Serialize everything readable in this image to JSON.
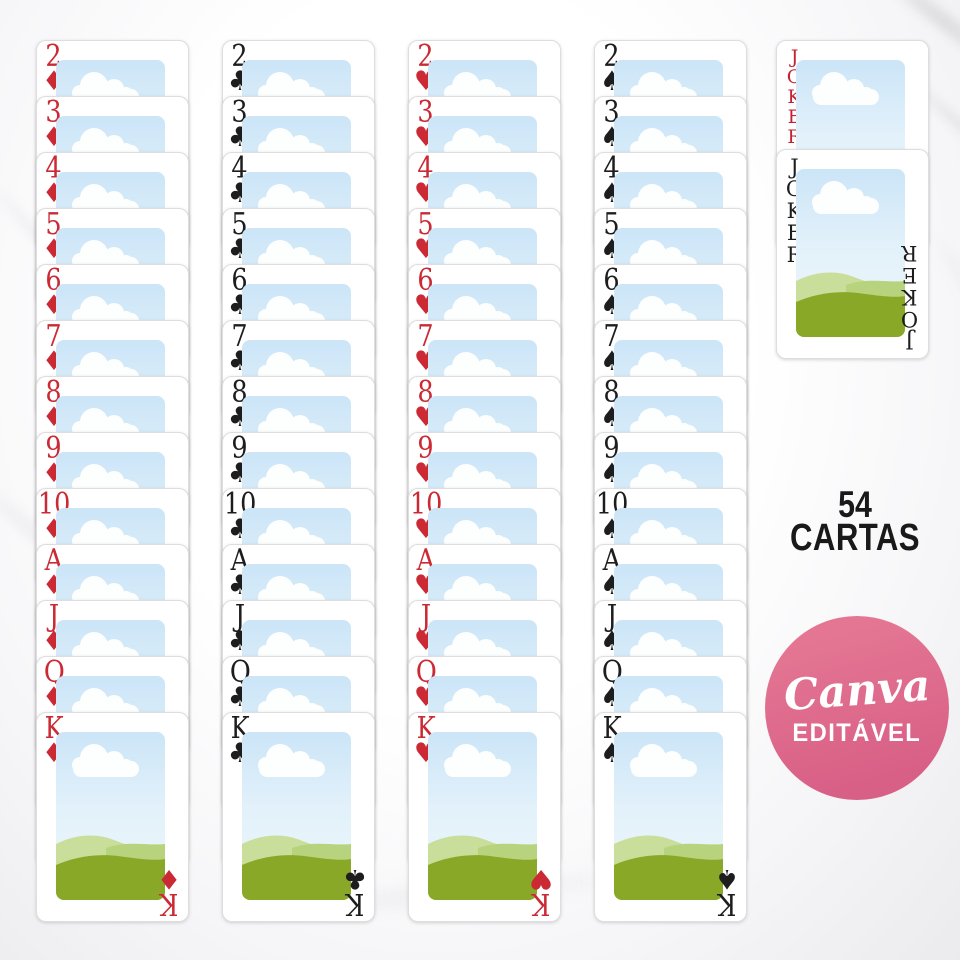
{
  "deck": {
    "ranks": [
      "2",
      "3",
      "4",
      "5",
      "6",
      "7",
      "8",
      "9",
      "10",
      "A",
      "J",
      "Q",
      "K"
    ],
    "suits": [
      {
        "name": "diamonds",
        "symbol": "♦",
        "color": "#cb2a34"
      },
      {
        "name": "clubs",
        "symbol": "♣",
        "color": "#1d1d1d"
      },
      {
        "name": "hearts",
        "symbol": "♥",
        "color": "#cb2a34"
      },
      {
        "name": "spades",
        "symbol": "♠",
        "color": "#1d1d1d"
      }
    ],
    "jokers": [
      {
        "label": "JOKER",
        "color": "#c32233"
      },
      {
        "label": "JOKER",
        "color": "#1d1d1d"
      }
    ]
  },
  "card_art": {
    "sky_top": "#cbe5f7",
    "sky_mid": "#e2f1fa",
    "sky_bottom": "#eef7fc",
    "cloud": "#fdfefe",
    "hill_back": "#c9de9b",
    "hill_mid": "#b7d37e",
    "hill_front": "#8aa827"
  },
  "info": {
    "line1": "54",
    "line2": "CARTAS",
    "color": "#191919"
  },
  "badge": {
    "brand": "Canva",
    "label": "EDITÁVEL",
    "bg_top": "#e47693",
    "bg_bottom": "#d85f86",
    "text_color": "#ffffff"
  }
}
